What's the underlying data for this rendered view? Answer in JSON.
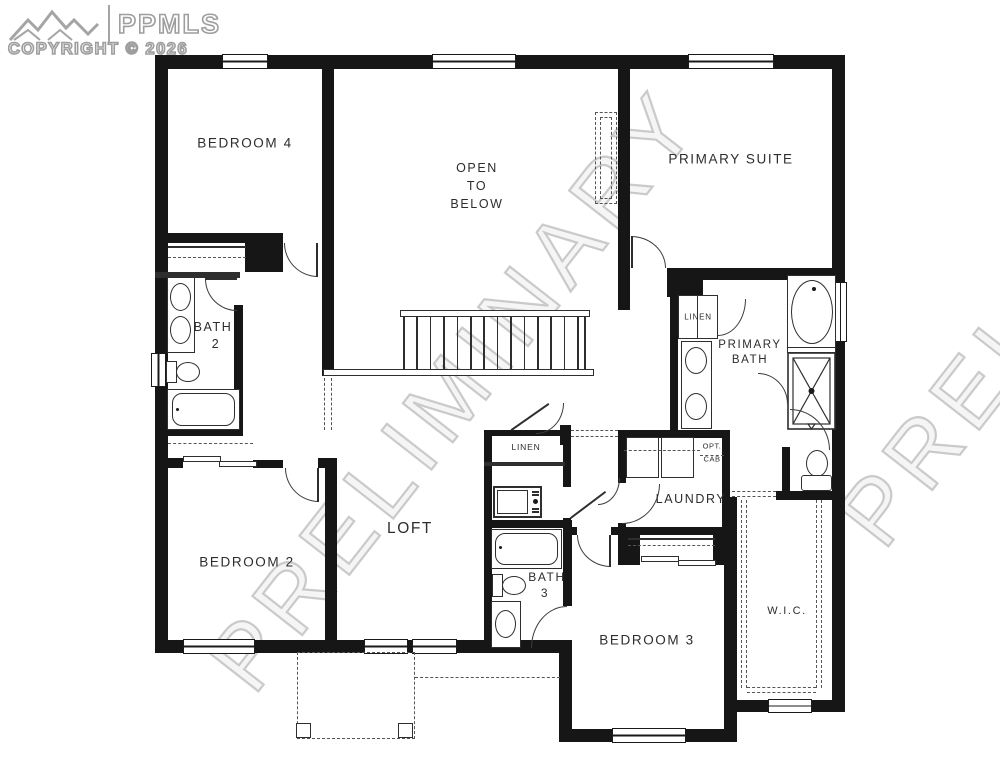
{
  "logo": {
    "brand": "PPMLS",
    "copyright": "COPYRIGHT © 2026"
  },
  "watermark": {
    "text": "PRELIMINARY"
  },
  "rooms": {
    "bedroom4": {
      "label": "BEDROOM 4"
    },
    "open_below": {
      "line1": "OPEN",
      "line2": "TO",
      "line3": "BELOW"
    },
    "primary_suite": {
      "label": "PRIMARY SUITE"
    },
    "bath2": {
      "line1": "BATH",
      "line2": "2"
    },
    "primary_linen": {
      "label": "LINEN"
    },
    "primary_bath": {
      "line1": "PRIMARY",
      "line2": "BATH"
    },
    "opt_cab": {
      "line1": "OPT.",
      "line2": "CAB"
    },
    "laundry": {
      "label": "LAUNDRY"
    },
    "loft": {
      "label": "LOFT"
    },
    "hall_linen": {
      "label": "LINEN"
    },
    "bath3": {
      "line1": "BATH",
      "line2": "3"
    },
    "bedroom2": {
      "label": "BEDROOM 2"
    },
    "bedroom3": {
      "label": "BEDROOM 3"
    },
    "wic": {
      "label": "W.I.C."
    }
  }
}
